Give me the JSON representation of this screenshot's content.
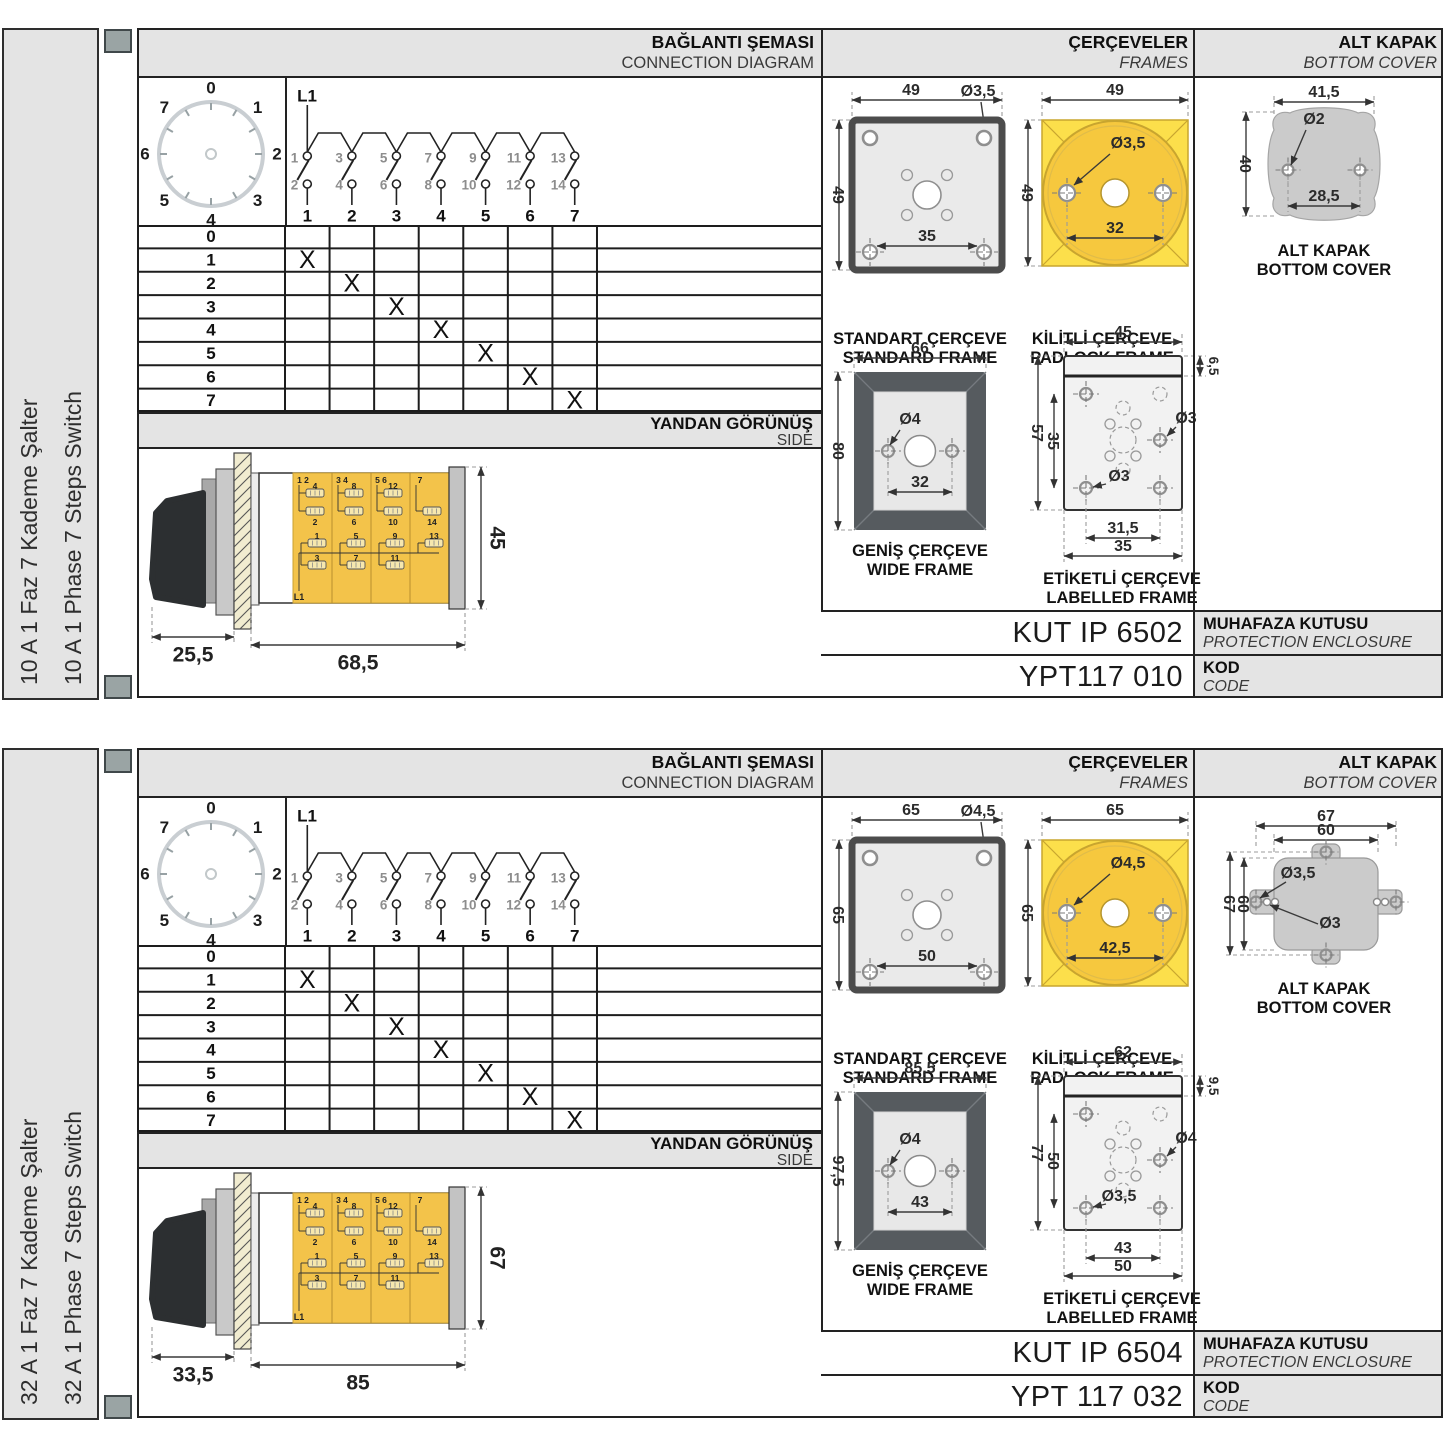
{
  "shared": {
    "headers": {
      "connection_tr": "BAĞLANTI ŞEMASI",
      "connection_en": "CONNECTION DIAGRAM",
      "frames_tr": "ÇERÇEVELER",
      "frames_en": "FRAMES",
      "cover_tr": "ALT KAPAK",
      "cover_en": "BOTTOM COVER",
      "side_tr": "YANDAN GÖRÜNÜŞ",
      "side_en": "SIDE"
    },
    "captions": {
      "standard_tr": "STANDART ÇERÇEVE",
      "standard_en": "STANDARD FRAME",
      "padlock_tr": "KİLİTLİ ÇERÇEVE",
      "padlock_en": "PADLOCK FRAME",
      "wide_tr": "GENİŞ ÇERÇEVE",
      "wide_en": "WIDE FRAME",
      "labelled_tr": "ETİKETLİ ÇERÇEVE",
      "labelled_en": "LABELLED FRAME",
      "cover_tr": "ALT KAPAK",
      "cover_en": "BOTTOM COVER",
      "enclosure_tr": "MUHAFAZA KUTUSU",
      "enclosure_en": "PROTECTION ENCLOSURE",
      "code_tr": "KOD",
      "code_en": "CODE"
    },
    "dial_positions": [
      "0",
      "1",
      "2",
      "3",
      "4",
      "5",
      "6",
      "7"
    ],
    "contact": {
      "line": "L1",
      "tops": [
        "1",
        "3",
        "5",
        "7",
        "9",
        "11",
        "13"
      ],
      "bottoms": [
        "2",
        "4",
        "6",
        "8",
        "10",
        "12",
        "14"
      ],
      "columns": [
        "1",
        "2",
        "3",
        "4",
        "5",
        "6",
        "7"
      ]
    },
    "table": {
      "row_labels": [
        "0",
        "1",
        "2",
        "3",
        "4",
        "5",
        "6",
        "7"
      ],
      "mark": "X",
      "marks": [
        [
          1,
          1
        ],
        [
          2,
          2
        ],
        [
          3,
          3
        ],
        [
          4,
          4
        ],
        [
          5,
          5
        ],
        [
          6,
          6
        ],
        [
          7,
          7
        ]
      ]
    },
    "modules": [
      {
        "pair": "1 2",
        "a": "4",
        "b": "2",
        "c": "1",
        "d": "3"
      },
      {
        "pair": "3 4",
        "a": "8",
        "b": "6",
        "c": "5",
        "d": "7"
      },
      {
        "pair": "5 6",
        "a": "12",
        "b": "10",
        "c": "9",
        "d": "11"
      },
      {
        "pair": "7",
        "a": "",
        "b": "14",
        "c": "13",
        "d": ""
      }
    ]
  },
  "sections": [
    {
      "label_tr": "10 A 1 Faz 7 Kademe Şalter",
      "label_en": "10 A 1 Phase 7 Steps Switch",
      "side_view": {
        "front": "25,5",
        "body": "68,5",
        "height": "45"
      },
      "standard": {
        "w": "49",
        "h": "49",
        "hole": "Ø3,5",
        "pitch": "35"
      },
      "padlock": {
        "w": "49",
        "h": "49",
        "hole": "Ø3,5",
        "pitch": "32"
      },
      "wide": {
        "w": "66",
        "h": "80",
        "hole": "Ø4",
        "pitch": "32"
      },
      "labelled": {
        "w": "45",
        "strip": "6,5",
        "h": "57",
        "inner": "35",
        "hole_right": "Ø3",
        "hole_left": "Ø3",
        "pitch1": "31,5",
        "pitch2": "35"
      },
      "cover": {
        "w1": "41,5",
        "hole1": "Ø2",
        "h1": "40",
        "pitch": "28,5"
      },
      "enclosure_code": "KUT IP 6502",
      "order_code": "YPT117 010"
    },
    {
      "label_tr": "32 A 1 Faz 7 Kademe Şalter",
      "label_en": "32 A 1 Phase 7 Steps Switch",
      "side_view": {
        "front": "33,5",
        "body": "85",
        "height": "67"
      },
      "standard": {
        "w": "65",
        "h": "65",
        "hole": "Ø4,5",
        "pitch": "50"
      },
      "padlock": {
        "w": "65",
        "h": "65",
        "hole": "Ø4,5",
        "pitch": "42,5"
      },
      "wide": {
        "w": "85,5",
        "h": "97,5",
        "hole": "Ø4",
        "pitch": "43"
      },
      "labelled": {
        "w": "62",
        "strip": "9,5",
        "h": "77",
        "inner": "50",
        "hole_right": "Ø4",
        "hole_left": "Ø3,5",
        "pitch1": "43",
        "pitch2": "50"
      },
      "cover": {
        "w1": "67",
        "w2": "60",
        "h1": "67",
        "h2": "60",
        "hole1": "Ø3,5",
        "hole2": "Ø3"
      },
      "enclosure_code": "KUT IP 6504",
      "order_code": "YPT 117 032"
    }
  ]
}
